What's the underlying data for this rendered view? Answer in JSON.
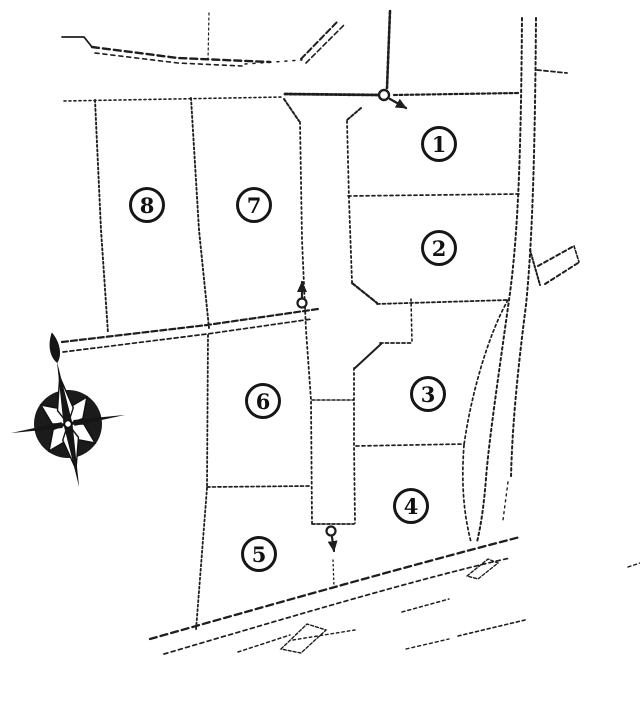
{
  "map": {
    "background_color": "#ffffff",
    "ink_color": "#1e1e1e",
    "parcels": [
      {
        "name": "parcel-1",
        "number": "1"
      },
      {
        "name": "parcel-2",
        "number": "2"
      },
      {
        "name": "parcel-3",
        "number": "3"
      },
      {
        "name": "parcel-4",
        "number": "4"
      },
      {
        "name": "parcel-5",
        "number": "5"
      },
      {
        "name": "parcel-6",
        "number": "6"
      },
      {
        "name": "parcel-7",
        "number": "7"
      },
      {
        "name": "parcel-8",
        "number": "8"
      }
    ],
    "markers": [
      {
        "name": "flow-arrow-top",
        "direction": "southeast"
      },
      {
        "name": "flow-arrow-middle",
        "direction": "north"
      },
      {
        "name": "flow-arrow-bottom",
        "direction": "south"
      }
    ],
    "compass": {
      "name": "compass-rose",
      "needle_points": "north-northwest"
    }
  }
}
